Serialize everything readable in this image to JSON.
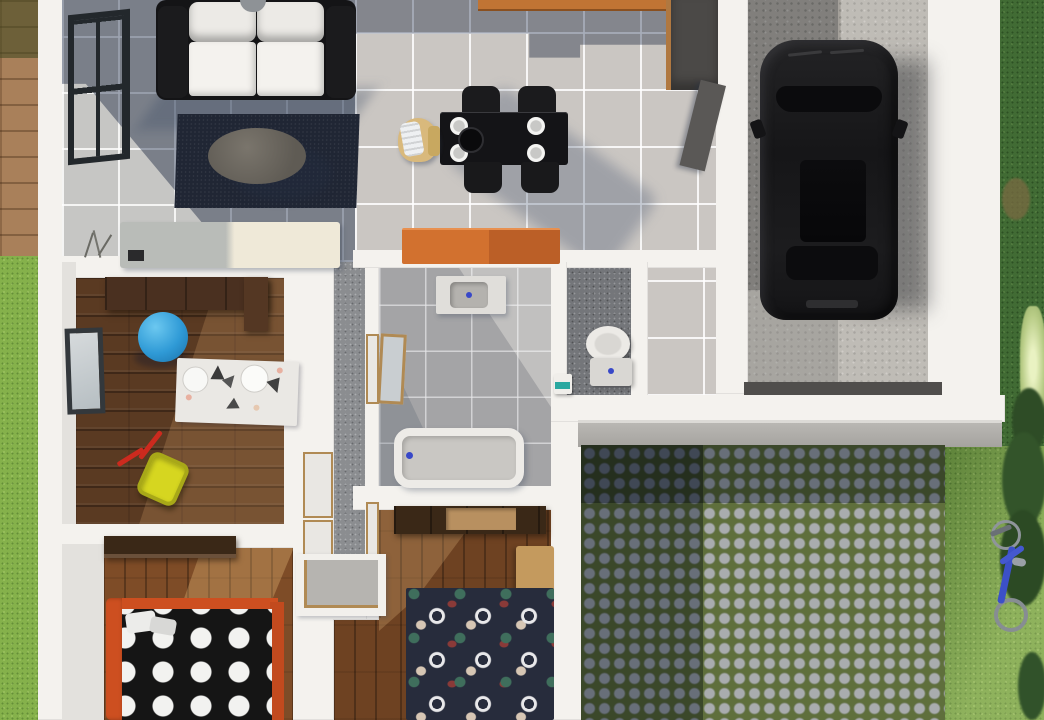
{
  "meta": {
    "title": "3D rendered top-down floor plan of a single-storey house with garage, patio and garden",
    "view": "top-down-3d-render",
    "width_px": 1044,
    "height_px": 720
  },
  "palette": {
    "wall": "#f4f2ee",
    "tile_main": "#cac6c2",
    "tile_bath": "#a4a4a6",
    "tile_wc": "#74767a",
    "wood_dark": "#5a3a22",
    "wood_mid": "#7e4c27",
    "deck": "#a9805a",
    "grass_bright": "#85b14b",
    "grass_dark": "#416b34",
    "moss": "#5f6f3c",
    "concrete": "#a4a09a",
    "car_black": "#1a1a1c",
    "orange": "#d2712f",
    "bed_orange": "#cd4f20",
    "rug_navy": "#202634",
    "duvet_black": "#151515",
    "duvet_navy": "#272c3c",
    "ball_blue": "#2f9ad6",
    "cart_yellow": "#cfcf24",
    "handle_red": "#cc2a1e",
    "cabinet_dark": "#4b4947",
    "wood_trim": "#b08a54",
    "headboard_tan": "#c49a5e",
    "teal": "#2aa8a0",
    "faucet_blue": "#3848c8",
    "step_grey": "#b9b7b3",
    "threshold": "#504e4c",
    "bicycle_blue": "#3c50c8",
    "shadow_blue": "rgba(38,54,84,0.45)"
  },
  "lighting": {
    "sun_direction": "upper-left",
    "shadows_cast": "lower-right"
  },
  "outdoor": {
    "left": [
      "wood-deck",
      "lawn"
    ],
    "right": [
      "dark-lawn",
      "bright-lawn",
      "shrubs",
      "flower-bed",
      "blue-bicycle",
      "dry-patch"
    ],
    "front": [
      "garage-threshold",
      "concrete-step",
      "cobblestone-patio"
    ]
  },
  "rooms": [
    {
      "id": "living-room",
      "floor": "blue-grey-tile-in-shadow",
      "items": [
        "white-sofa-black-frame",
        "navy-rug",
        "oval-coffee-table",
        "two-tone-sideboard",
        "twig-decor",
        "tall-window"
      ]
    },
    {
      "id": "kitchen-dining",
      "floor": "light-grey-tile",
      "items": [
        "black-dining-table",
        "four-black-chairs",
        "four-white-plates",
        "centre-bowl",
        "wooden-high-chair",
        "orange-island",
        "orange-counter",
        "dark-tall-cabinet",
        "open-door-to-garage"
      ]
    },
    {
      "id": "kids-room",
      "floor": "dark-wood-planks",
      "items": [
        "dark-wardrobe",
        "blue-ball",
        "animal-print-rug",
        "yellow-toy-cart-red-handles",
        "window"
      ]
    },
    {
      "id": "hallway",
      "floor": "grey-speckled-tile",
      "items": [
        "door",
        "door",
        "door",
        "door",
        "open-closet"
      ]
    },
    {
      "id": "bathroom",
      "floor": "grey-tile",
      "items": [
        "vanity-with-basin",
        "wall-mirror",
        "bathtub"
      ]
    },
    {
      "id": "wc",
      "floor": "dark-grey-tile",
      "items": [
        "toilet",
        "small-white-unit-teal-front"
      ]
    },
    {
      "id": "bedroom-1",
      "floor": "wood-planks",
      "items": [
        "dark-wardrobe",
        "orange-frame-bed",
        "black-duvet-white-dots",
        "pillows"
      ]
    },
    {
      "id": "bedroom-2",
      "floor": "wood-planks",
      "items": [
        "dark-wardrobe",
        "tan-headboard",
        "navy-duvet-multicolour-dots"
      ]
    },
    {
      "id": "garage",
      "floor": "concrete",
      "items": [
        "black-car-top-view"
      ]
    }
  ]
}
